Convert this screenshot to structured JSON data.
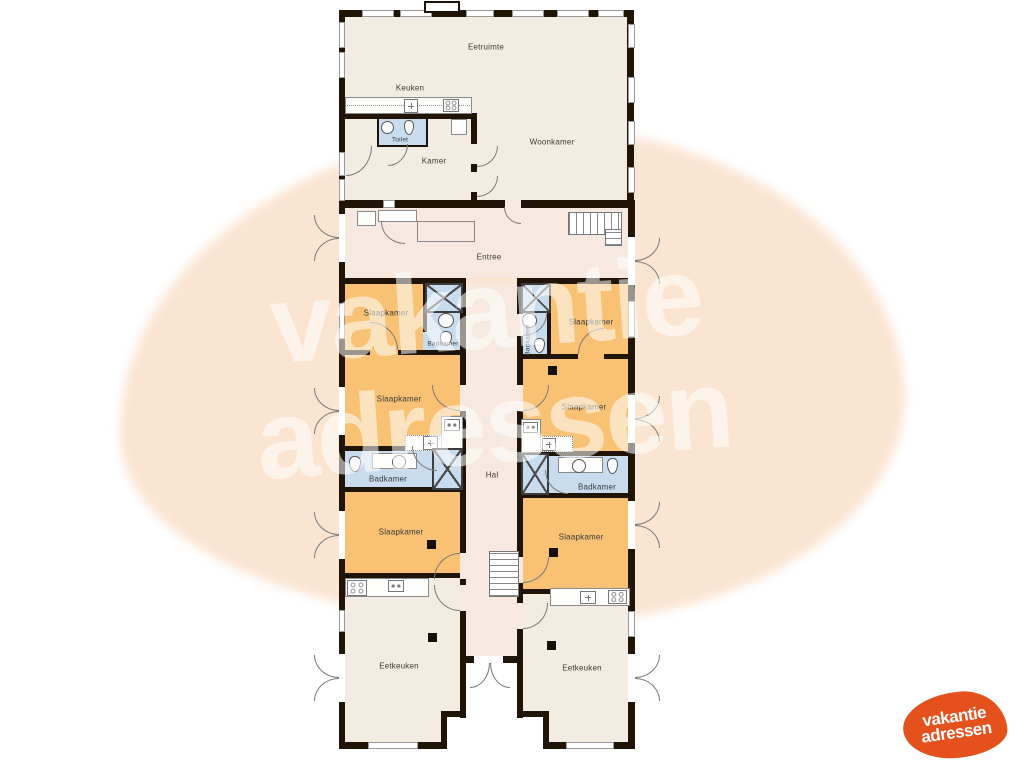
{
  "watermark": {
    "line1": "vakantie",
    "line2": "adressen"
  },
  "logo": {
    "line1": "vakantie",
    "line2": "adressen"
  },
  "labels": {
    "eetruimte": "Eetruimte",
    "keuken": "Keuken",
    "toilet": "Toilet",
    "kamer": "Kamer",
    "woonkamer": "Woonkamer",
    "entree": "Entree",
    "hal": "Hal",
    "slaapkamer": "Slaapkamer",
    "badkamer": "Badkamer",
    "eetkeuken": "Eetkeuken"
  },
  "colors": {
    "bedroom": "#f8c173",
    "bathroom": "#c8dcee",
    "floor": "#f3ece2",
    "hallfloor": "#f7e9df",
    "wall": "#201407",
    "blob": "#fae5d3",
    "logo": "#e4511d",
    "watermark": "#ffffff"
  }
}
